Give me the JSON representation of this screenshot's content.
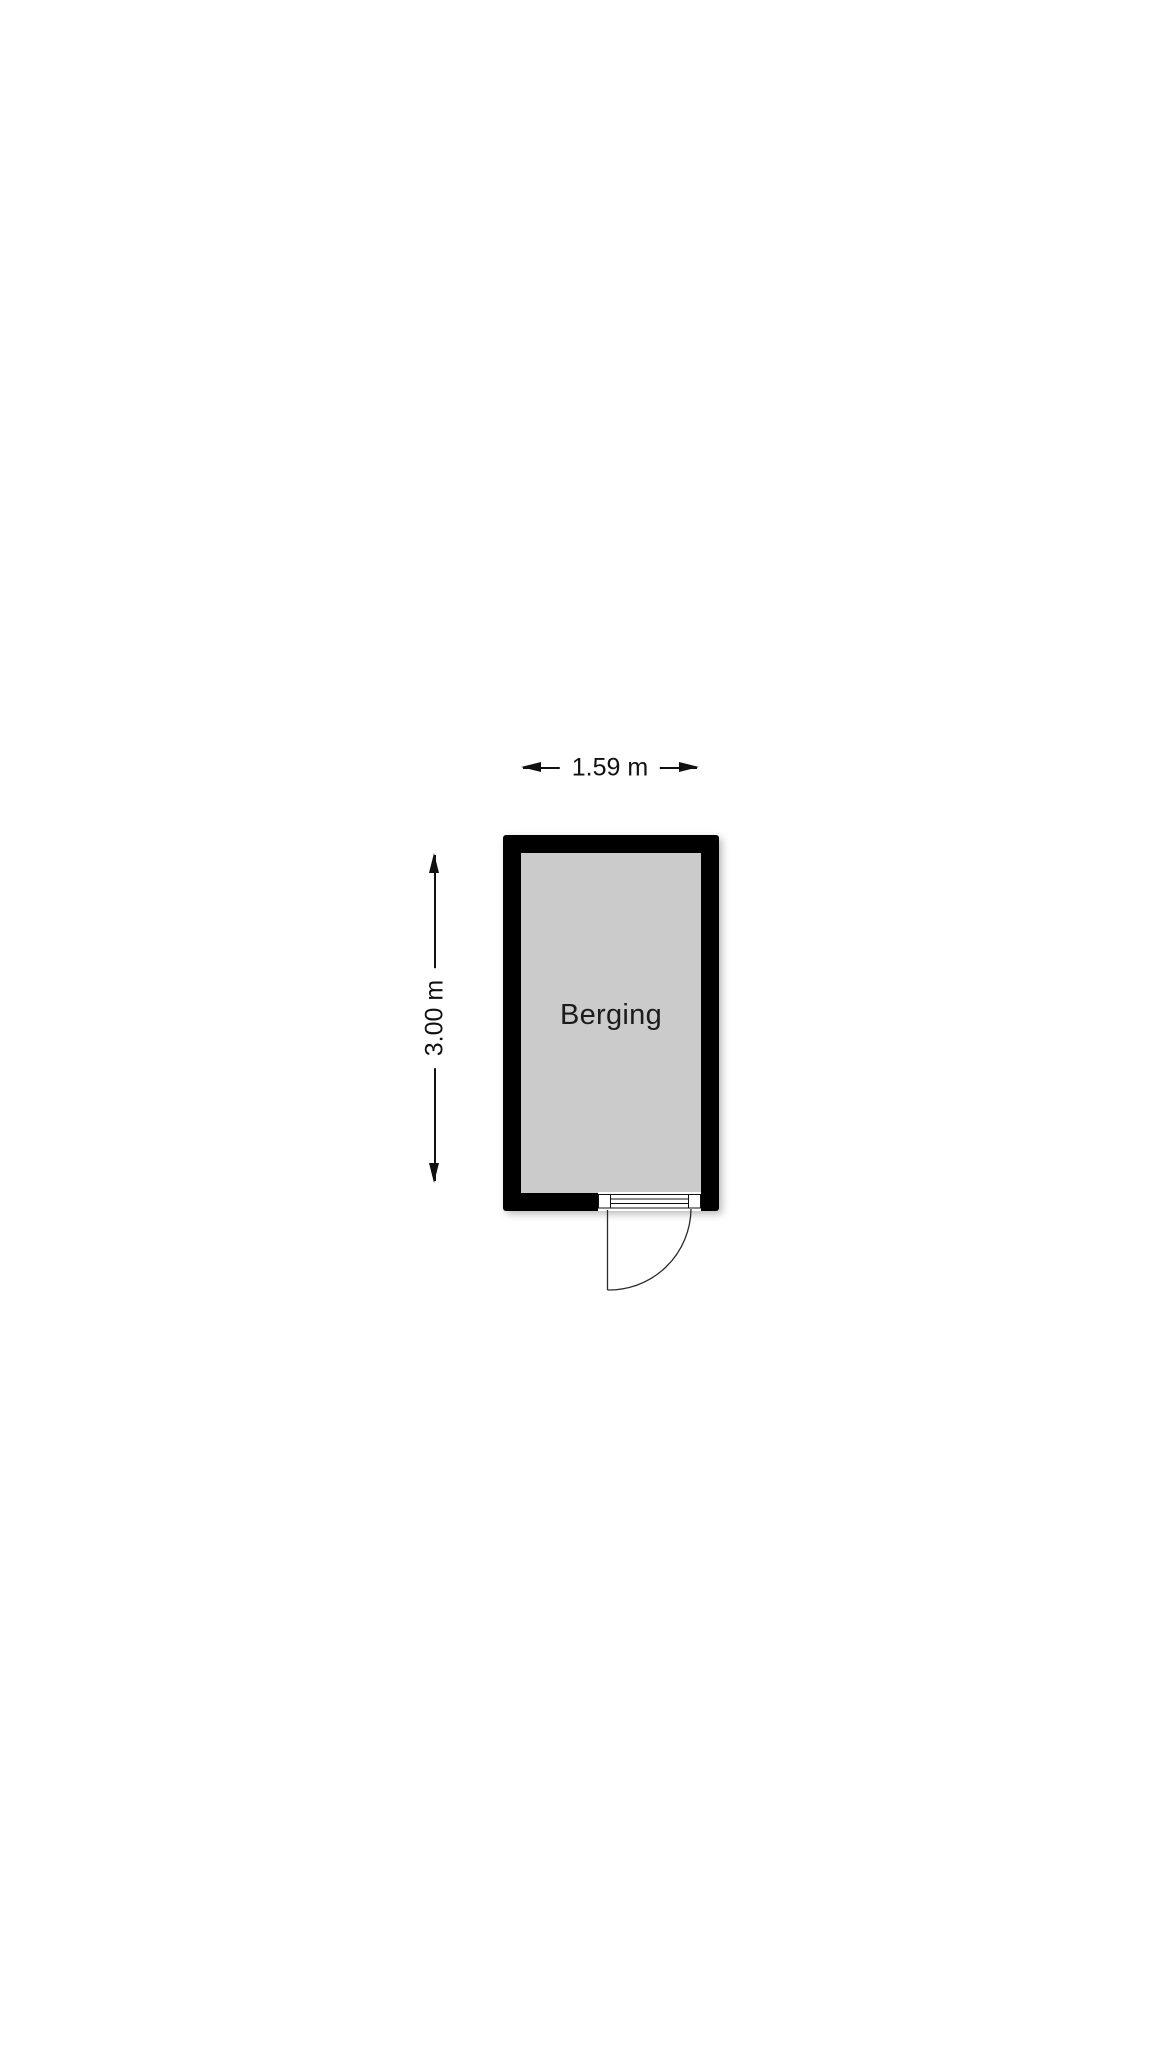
{
  "floorplan": {
    "room": {
      "label": "Berging"
    },
    "dimensions": {
      "width_label": "1.59 m",
      "height_label": "3.00 m"
    },
    "colors": {
      "background": "#ffffff",
      "wall": "#000000",
      "floor": "#cbcbcb",
      "line": "#111111"
    }
  }
}
